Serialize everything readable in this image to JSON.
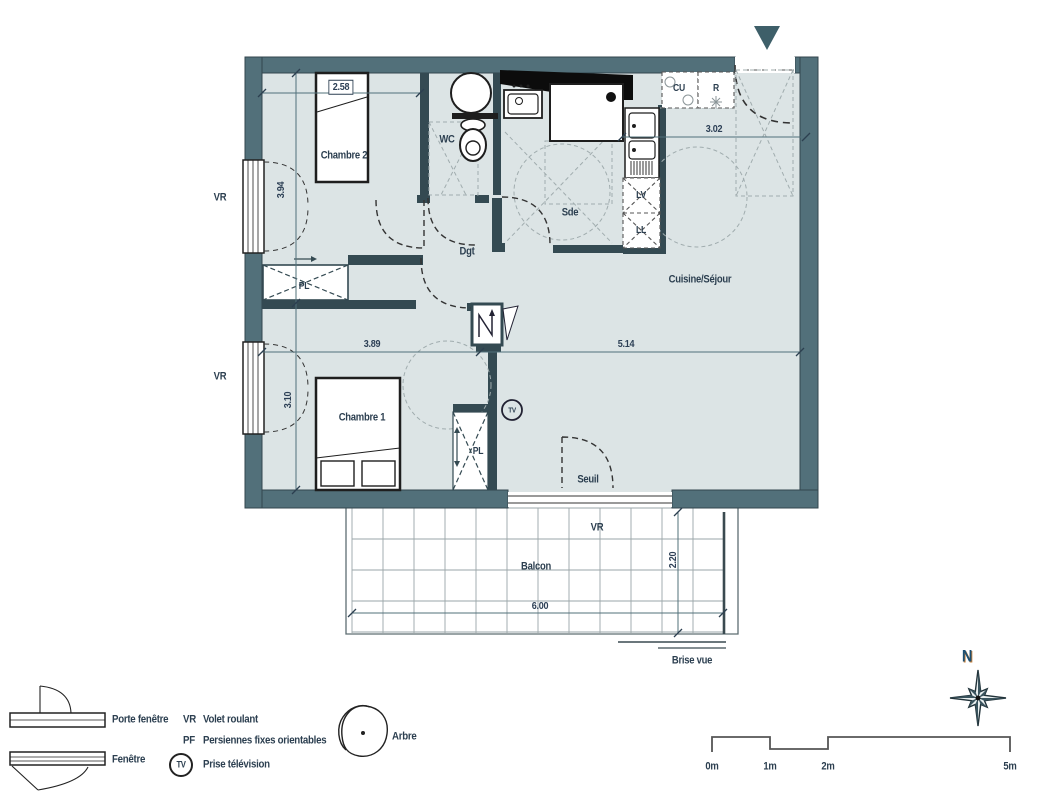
{
  "labels": {
    "chambre1": "Chambre 1",
    "chambre2": "Chambre 2",
    "wc": "WC",
    "sde": "Sde",
    "dgt": "Dgt",
    "cuisine_sejour": "Cuisine/Séjour",
    "seuil": "Seuil",
    "balcon": "Balcon",
    "brise_vue": "Brise vue",
    "pl": "PL",
    "cu": "CU",
    "refrigerateur": "R",
    "lave_vaisselle": "LV",
    "lave_linge": "LL",
    "volet_roulant": "VR",
    "prise_tv": "TV"
  },
  "dimensions": {
    "chambre2_largeur": "2.58",
    "gauche_haut": "3.94",
    "gauche_bas": "3.10",
    "chambre1_largeur": "3.89",
    "sejour_largeur": "5.14",
    "cuisine_largeur": "3.02",
    "balcon_largeur": "6.00",
    "balcon_profondeur": "2.20"
  },
  "legend": {
    "porte_fenetre": "Porte fenêtre",
    "fenetre": "Fenêtre",
    "vr_abbr": "VR",
    "vr_label": "Volet roulant",
    "pf_abbr": "PF",
    "pf_label": "Persiennes fixes orientables",
    "tv_abbr": "TV",
    "tv_label": "Prise télévision",
    "arbre": "Arbre"
  },
  "scalebar": {
    "m0": "0m",
    "m1": "1m",
    "m2": "2m",
    "m5": "5m"
  },
  "compass": {
    "north": "N"
  }
}
